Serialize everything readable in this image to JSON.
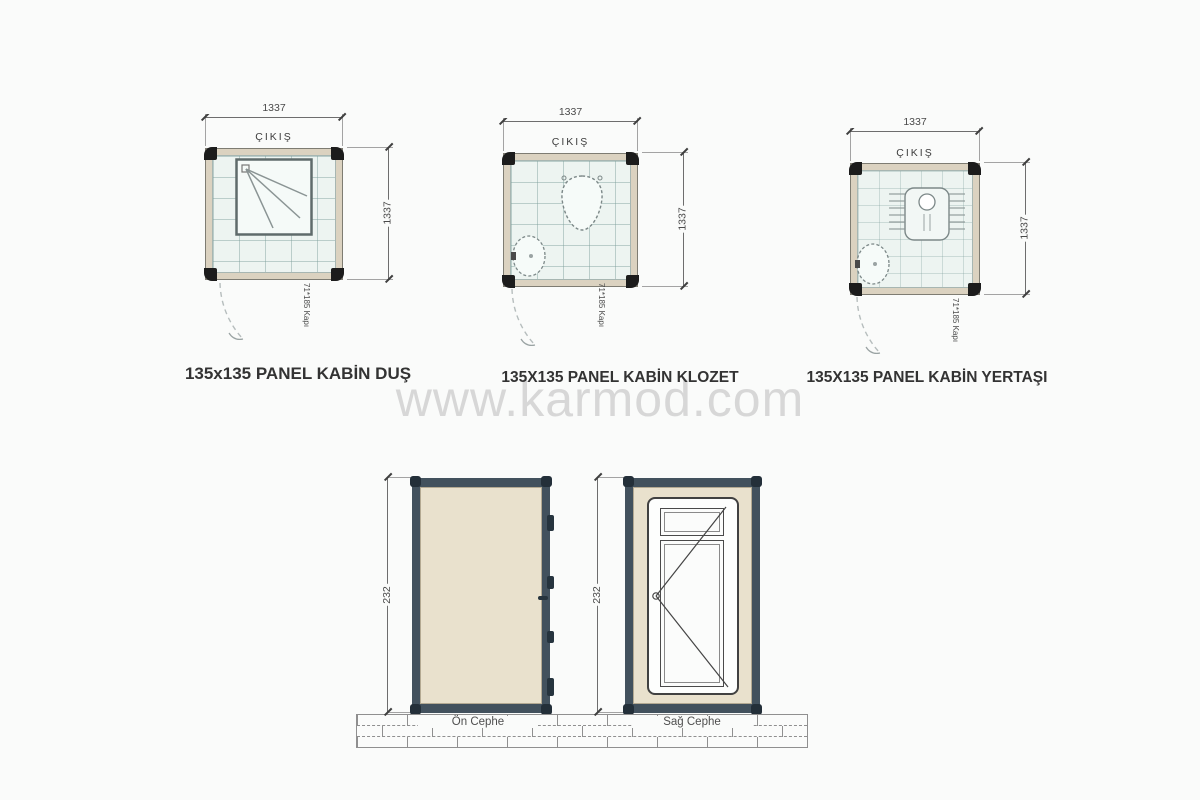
{
  "watermark": "www.karmod.com",
  "plans": [
    {
      "title": "135x135 PANEL KABİN DUŞ",
      "exit_label": "ÇIKIŞ",
      "width_dim": "1337",
      "height_dim": "1337",
      "door_label": "71*185 Kapı",
      "fixture": "shower-tray"
    },
    {
      "title": "135X135 PANEL KABİN KLOZET",
      "exit_label": "ÇIKIŞ",
      "width_dim": "1337",
      "height_dim": "1337",
      "door_label": "71*185 Kapı",
      "fixture": "toilet-and-sink"
    },
    {
      "title": "135X135 PANEL KABİN YERTAŞI",
      "exit_label": "ÇIKIŞ",
      "width_dim": "1337",
      "height_dim": "1337",
      "door_label": "71*185 Kapı",
      "fixture": "squat-toilet-and-sink"
    }
  ],
  "elevations": [
    {
      "label": "Ön Cephe",
      "height_dim": "232"
    },
    {
      "label": "Sağ Cephe",
      "height_dim": "232"
    }
  ],
  "colors": {
    "wall_beige": "#dbd2c0",
    "tile_fill": "#edf4f1",
    "frame_dark": "#42515d",
    "elevation_panel": "#e9e1cd",
    "watermark_gray": "#d7d7d7"
  }
}
